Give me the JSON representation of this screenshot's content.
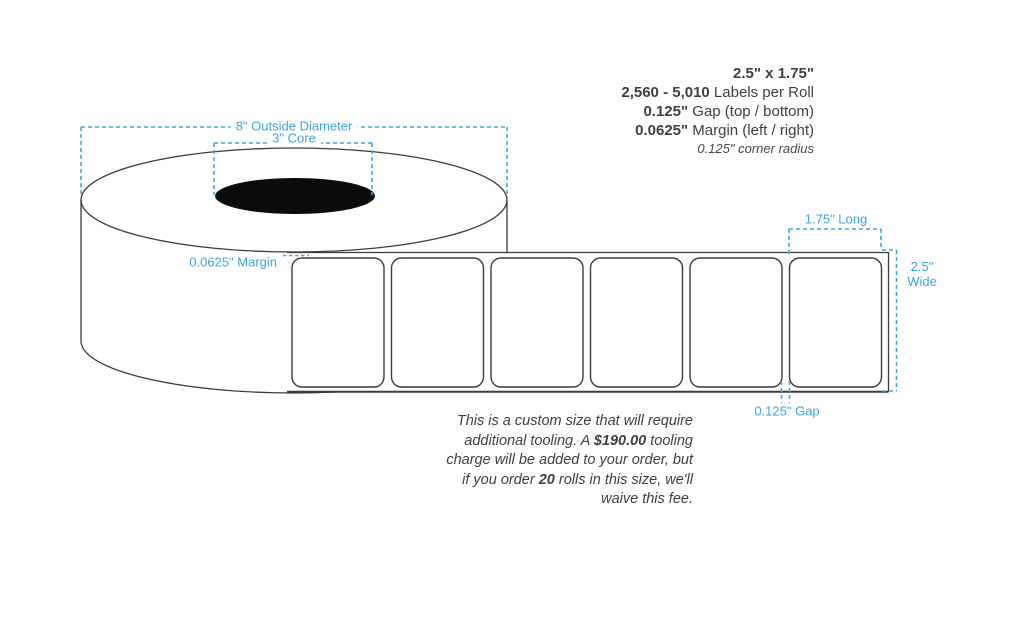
{
  "specs": {
    "size": "2.5\" x 1.75\"",
    "quantity_range": "2,560 - 5,010",
    "quantity_suffix": " Labels per Roll",
    "gap_value": "0.125\"",
    "gap_suffix": " Gap (top / bottom)",
    "margin_value": "0.0625\"",
    "margin_suffix": " Margin (left / right)",
    "corner_radius_note": "0.125\" corner radius"
  },
  "diagram": {
    "outside_diameter_label": "8\" Outside Diameter",
    "core_label": "3\" Core",
    "margin_label": "0.0625\" Margin",
    "length_label": "1.75\" Long",
    "width_label_line1": "2.5\"",
    "width_label_line2": "Wide",
    "gap_label": "0.125\" Gap",
    "labels_shown": 6,
    "accent_color": "#3fa5dc",
    "outline_color": "#3c3c3c",
    "core_fill_color": "#0c0c0c"
  },
  "note": {
    "part1": "This is a custom size that will require additional tooling. A ",
    "tooling_charge": "$190.00",
    "part2": " tooling charge will be added to your order, but if you order ",
    "rolls_quantity": "20",
    "part3": " rolls in this size, we'll waive this fee."
  }
}
